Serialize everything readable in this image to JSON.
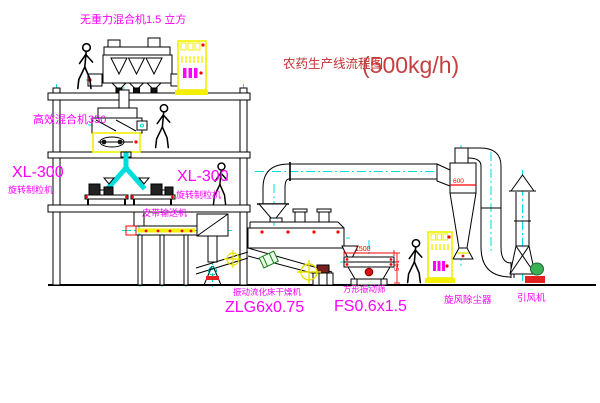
{
  "title": {
    "name": "农药生产线流程图",
    "capacity": "(500kg/h)"
  },
  "labels": {
    "gravity_free_mixer": "无重力混合机1.5 立方",
    "mixer_350": "高效混合机350",
    "granulator_left": {
      "model": "XL-300",
      "name": "旋转制粒机"
    },
    "granulator_right": {
      "model": "XL-300",
      "name": "旋转制粒机"
    },
    "belt_conveyor": "皮带输送机",
    "fluid_bed_dryer": {
      "name": "振动流化床干燥机",
      "model": "ZLG6x0.75"
    },
    "vibrating_sieve": {
      "name": "方形振动筛",
      "model": "FS0.6x1.5"
    },
    "cyclone": "旋风除尘器",
    "induced_draft_fan": "引风机"
  },
  "dimensions": {
    "sieve_length": "1500",
    "sieve_height": "541",
    "cyclone_inlet": "600"
  },
  "colors": {
    "label_magenta": "#ff00ff",
    "title_red": "#c23030",
    "dimension_red": "#ff0000",
    "centerline_cyan": "#00dddd",
    "cabinet_yellow": "#f2ef00",
    "motor_green": "#3cb054",
    "line_black": "#000000"
  },
  "icons": {
    "person_figure": "walking-worker-outline",
    "center_mark": "yellow-circle-cross",
    "control_cabinet": "yellow-electric-panel"
  }
}
